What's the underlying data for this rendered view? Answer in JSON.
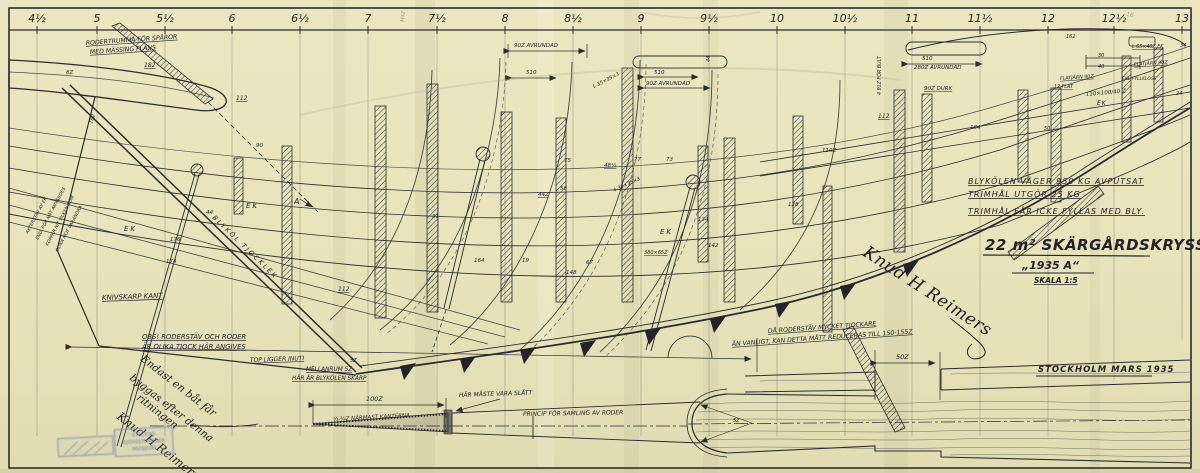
{
  "ruler": {
    "stations": [
      "4½",
      "5",
      "5½",
      "6",
      "6½",
      "7",
      "7½",
      "8",
      "8½",
      "9",
      "9½",
      "10",
      "10½",
      "11",
      "11½",
      "12",
      "12½",
      "13"
    ]
  },
  "title_block": {
    "note1": "BLYKÖLEN VÄGER 950 KG AVPUTSAT",
    "note2": "TRIMHÅL UTGÖR 25 KG",
    "note3": "TRIMHÅL FÅR ICKE FYLLAS MED BLY.",
    "title": "22 m² SKÄRGÅRDSKRYSSARE",
    "subtitle": "„1935 A“",
    "scale": "SKALA 1:5",
    "place_date": "STOCKHOLM MARS 1935"
  },
  "notes": {
    "rodertrumma1": "RODERTRUMMA FÖR SPÅROR",
    "rodertrumma2": "MED MÄSSING FLÄNS",
    "blykol": "BLYKÖL TJOCKLEK",
    "knivskarp": "KNIVSKARP KANT",
    "obs1": "OBS! RODERSTÄV OCH RODER",
    "obs2": "ÄR OLIKA TJOCK HÄR ANGIVES",
    "topligger": "TOP LIGGER INUTI",
    "mellanrum1": "MELLANRUM 5Z",
    "mellanrum2": "HÄR ÄR BLYKÖLEN SKARP",
    "roderstav1": "DÅ RODERSTÄV MYCKET TJOCKARE",
    "roderstav2": "ÄN VANLIGT, KAN DETTA MÅTT REDUCERAS TILL 150-155Z",
    "kanterna": "¼-¾Z NÄRMAST KANTERNA",
    "slatt": "HÄR MÅSTE VARA SLÄTT",
    "princip": "PRINCIP FÖR SAMLING AV RODER"
  },
  "handwritten_note": {
    "line1": "Endast en båt får",
    "line2": "byggas efter denna",
    "line3": "ritningen"
  },
  "signatures": {
    "main": "Knud H Reimers",
    "lower": "Knud H Reimers"
  },
  "stamp": {
    "line1": "STATENS",
    "line2": "SJÖHISTORISKA",
    "line3": "MUSEUM"
  },
  "labels": [
    {
      "t": "182",
      "x": 144,
      "y": 67,
      "s": 6,
      "u": 1
    },
    {
      "t": "8Z",
      "x": 66,
      "y": 74,
      "s": 5.5
    },
    {
      "t": "112",
      "x": 236,
      "y": 100,
      "s": 6,
      "u": 1
    },
    {
      "t": "90",
      "x": 256,
      "y": 147,
      "s": 5.5
    },
    {
      "t": "44",
      "x": 206,
      "y": 214,
      "s": 5.5
    },
    {
      "t": "176",
      "x": 170,
      "y": 241,
      "s": 5.5
    },
    {
      "t": "174",
      "x": 166,
      "y": 263,
      "s": 5.5
    },
    {
      "t": "162",
      "x": 92,
      "y": 124,
      "s": 5,
      "r": -70
    },
    {
      "t": "EK",
      "x": 124,
      "y": 231,
      "s": 7,
      "ls": 2
    },
    {
      "t": "EK",
      "x": 246,
      "y": 208,
      "s": 7,
      "ls": 2
    },
    {
      "t": "EK",
      "x": 660,
      "y": 234,
      "s": 7,
      "ls": 2
    },
    {
      "t": "EK",
      "x": 1097,
      "y": 105,
      "s": 6,
      "ls": 1
    },
    {
      "t": "A",
      "x": 294,
      "y": 204,
      "s": 8
    },
    {
      "t": "112",
      "x": 338,
      "y": 291,
      "s": 6,
      "u": 1
    },
    {
      "t": "5Z",
      "x": 350,
      "y": 362,
      "s": 5
    },
    {
      "t": "90Z AVRUNDAD",
      "x": 514,
      "y": 47,
      "s": 5.5
    },
    {
      "t": "510",
      "x": 526,
      "y": 74,
      "s": 5.5
    },
    {
      "t": "L 35×35×3",
      "x": 594,
      "y": 88,
      "s": 5,
      "r": -27
    },
    {
      "t": "510",
      "x": 654,
      "y": 74,
      "s": 5.5
    },
    {
      "t": "90Z AVRUNDAD",
      "x": 646,
      "y": 85,
      "s": 5.5
    },
    {
      "t": "44",
      "x": 710,
      "y": 62,
      "s": 5,
      "r": -90
    },
    {
      "t": "510",
      "x": 922,
      "y": 60,
      "s": 5.5
    },
    {
      "t": "280Z AVRUNDAD",
      "x": 914,
      "y": 69,
      "s": 5.5
    },
    {
      "t": "90Z DURK",
      "x": 924,
      "y": 90,
      "s": 5.5,
      "u": 1
    },
    {
      "t": "112",
      "x": 878,
      "y": 118,
      "s": 6,
      "u": 1
    },
    {
      "t": "4 91Z FÖR BULT",
      "x": 881,
      "y": 95,
      "s": 4.8,
      "r": -90
    },
    {
      "t": "48½",
      "x": 604,
      "y": 167,
      "s": 5.5,
      "u": 1
    },
    {
      "t": "77",
      "x": 634,
      "y": 161,
      "s": 5.5
    },
    {
      "t": "73",
      "x": 666,
      "y": 161,
      "s": 5.5
    },
    {
      "t": "75",
      "x": 564,
      "y": 162,
      "s": 5.5
    },
    {
      "t": "58",
      "x": 560,
      "y": 190,
      "s": 5.5
    },
    {
      "t": "44Z",
      "x": 538,
      "y": 196,
      "s": 5.5,
      "u": 1
    },
    {
      "t": "31",
      "x": 432,
      "y": 218,
      "s": 5.5
    },
    {
      "t": "380×65Z",
      "x": 644,
      "y": 254,
      "s": 5,
      "u": 1
    },
    {
      "t": "164",
      "x": 474,
      "y": 262,
      "s": 5.5
    },
    {
      "t": "19",
      "x": 522,
      "y": 262,
      "s": 5.5
    },
    {
      "t": "67",
      "x": 586,
      "y": 264,
      "s": 5.5
    },
    {
      "t": "148",
      "x": 566,
      "y": 274,
      "s": 5.5
    },
    {
      "t": "134",
      "x": 698,
      "y": 221,
      "s": 5.5
    },
    {
      "t": "142",
      "x": 708,
      "y": 247,
      "s": 5.5
    },
    {
      "t": "128",
      "x": 788,
      "y": 206,
      "s": 5.5
    },
    {
      "t": "110Z",
      "x": 822,
      "y": 152,
      "s": 5.5
    },
    {
      "t": "104",
      "x": 970,
      "y": 129,
      "s": 5.5
    },
    {
      "t": "4-35×35×3",
      "x": 614,
      "y": 192,
      "s": 5,
      "r": -25
    },
    {
      "t": "162",
      "x": 1066,
      "y": 38,
      "s": 5
    },
    {
      "t": "34",
      "x": 1180,
      "y": 47,
      "s": 5
    },
    {
      "t": "30",
      "x": 1098,
      "y": 57,
      "s": 5
    },
    {
      "t": "40",
      "x": 1098,
      "y": 68,
      "s": 5
    },
    {
      "t": "24",
      "x": 1176,
      "y": 95,
      "s": 5
    },
    {
      "t": "50",
      "x": 1044,
      "y": 130,
      "s": 5
    },
    {
      "t": "FLATJÄRN 90Z",
      "x": 1060,
      "y": 80,
      "s": 4.8,
      "u": 1,
      "r": -4
    },
    {
      "t": "12 FLAT",
      "x": 1054,
      "y": 88,
      "s": 4.8,
      "u": 1
    },
    {
      "t": "FLATJÄRN 90Z",
      "x": 1134,
      "y": 66,
      "s": 4.8,
      "u": 1,
      "r": -4
    },
    {
      "t": "L 65×40Z EK",
      "x": 1132,
      "y": 48,
      "s": 4.8,
      "u": 1
    },
    {
      "t": "EKL.FYLLKLOSS",
      "x": 1122,
      "y": 80,
      "s": 4.5
    },
    {
      "t": "110×100/40 Z",
      "x": 1086,
      "y": 96,
      "s": 5.5,
      "r": -5
    },
    {
      "t": "100Z",
      "x": 366,
      "y": 401,
      "s": 6.5
    },
    {
      "t": "50Z",
      "x": 896,
      "y": 359,
      "s": 6.5
    },
    {
      "t": "5Z",
      "x": 733,
      "y": 422,
      "s": 5
    },
    {
      "t": "AKTERSTÄV AV EK",
      "x": 28,
      "y": 234,
      "s": 4.5,
      "r": -62
    },
    {
      "t": "END. FÖR NÅT ANVÄNDES",
      "x": 38,
      "y": 240,
      "s": 4.5,
      "r": -62
    },
    {
      "t": "KOPPAR NIT VILKEN SOM",
      "x": 48,
      "y": 246,
      "s": 4.5,
      "r": -62
    },
    {
      "t": "OLIKA MOT VARANDRA",
      "x": 58,
      "y": 252,
      "s": 4.5,
      "r": -62
    },
    {
      "t": "M4Z",
      "x": 404,
      "y": 22,
      "s": 5,
      "r": -85,
      "c": "pencil"
    },
    {
      "t": "16",
      "x": 1126,
      "y": 16,
      "s": 6,
      "r": 8,
      "c": "pencil"
    }
  ]
}
